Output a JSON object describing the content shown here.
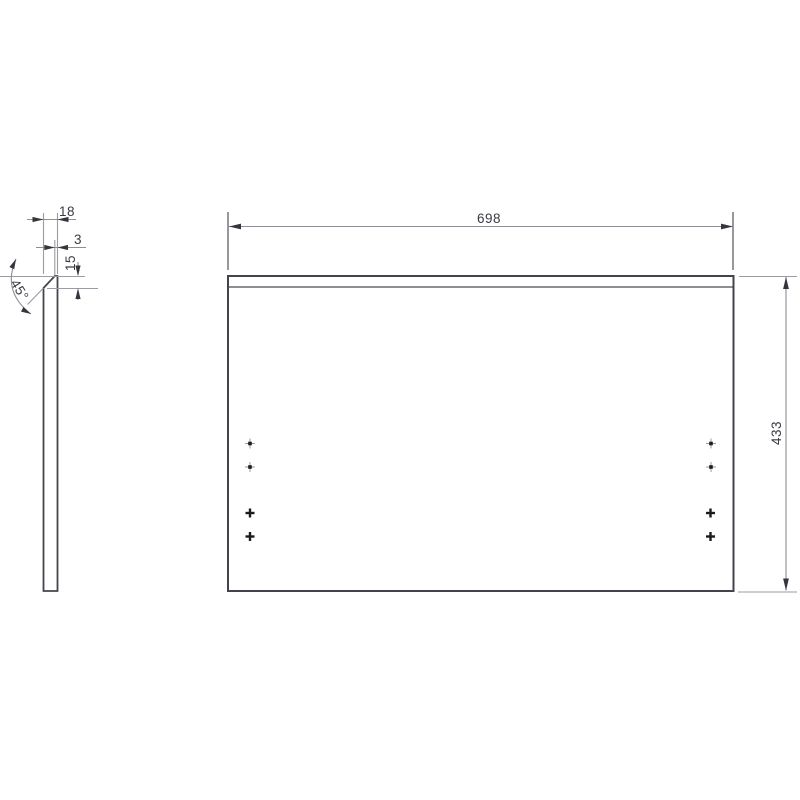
{
  "page": {
    "type": "technical-drawing",
    "background": "#ffffff"
  },
  "dimensions": {
    "width": {
      "value": "698",
      "orientation": "horizontal",
      "view": "front"
    },
    "height": {
      "value": "433",
      "orientation": "vertical",
      "view": "front"
    },
    "thickness": {
      "value": "18",
      "orientation": "horizontal",
      "view": "side-profile"
    },
    "edge_flat": {
      "value": "3",
      "orientation": "horizontal",
      "view": "side-profile"
    },
    "chamfer_depth": {
      "value": "15",
      "orientation": "vertical",
      "view": "side-profile"
    },
    "chamfer_angle": {
      "value": "45°",
      "orientation": "angular",
      "view": "side-profile"
    }
  },
  "markers": {
    "dot_markers": 4,
    "cross_markers": 4
  },
  "colors": {
    "object_line": "#45454d",
    "dimension_line": "#8e8e95",
    "extension_line": "#9b9ba1",
    "text": "#3a3a43",
    "marker": "#1b1b20",
    "background": "#ffffff"
  }
}
